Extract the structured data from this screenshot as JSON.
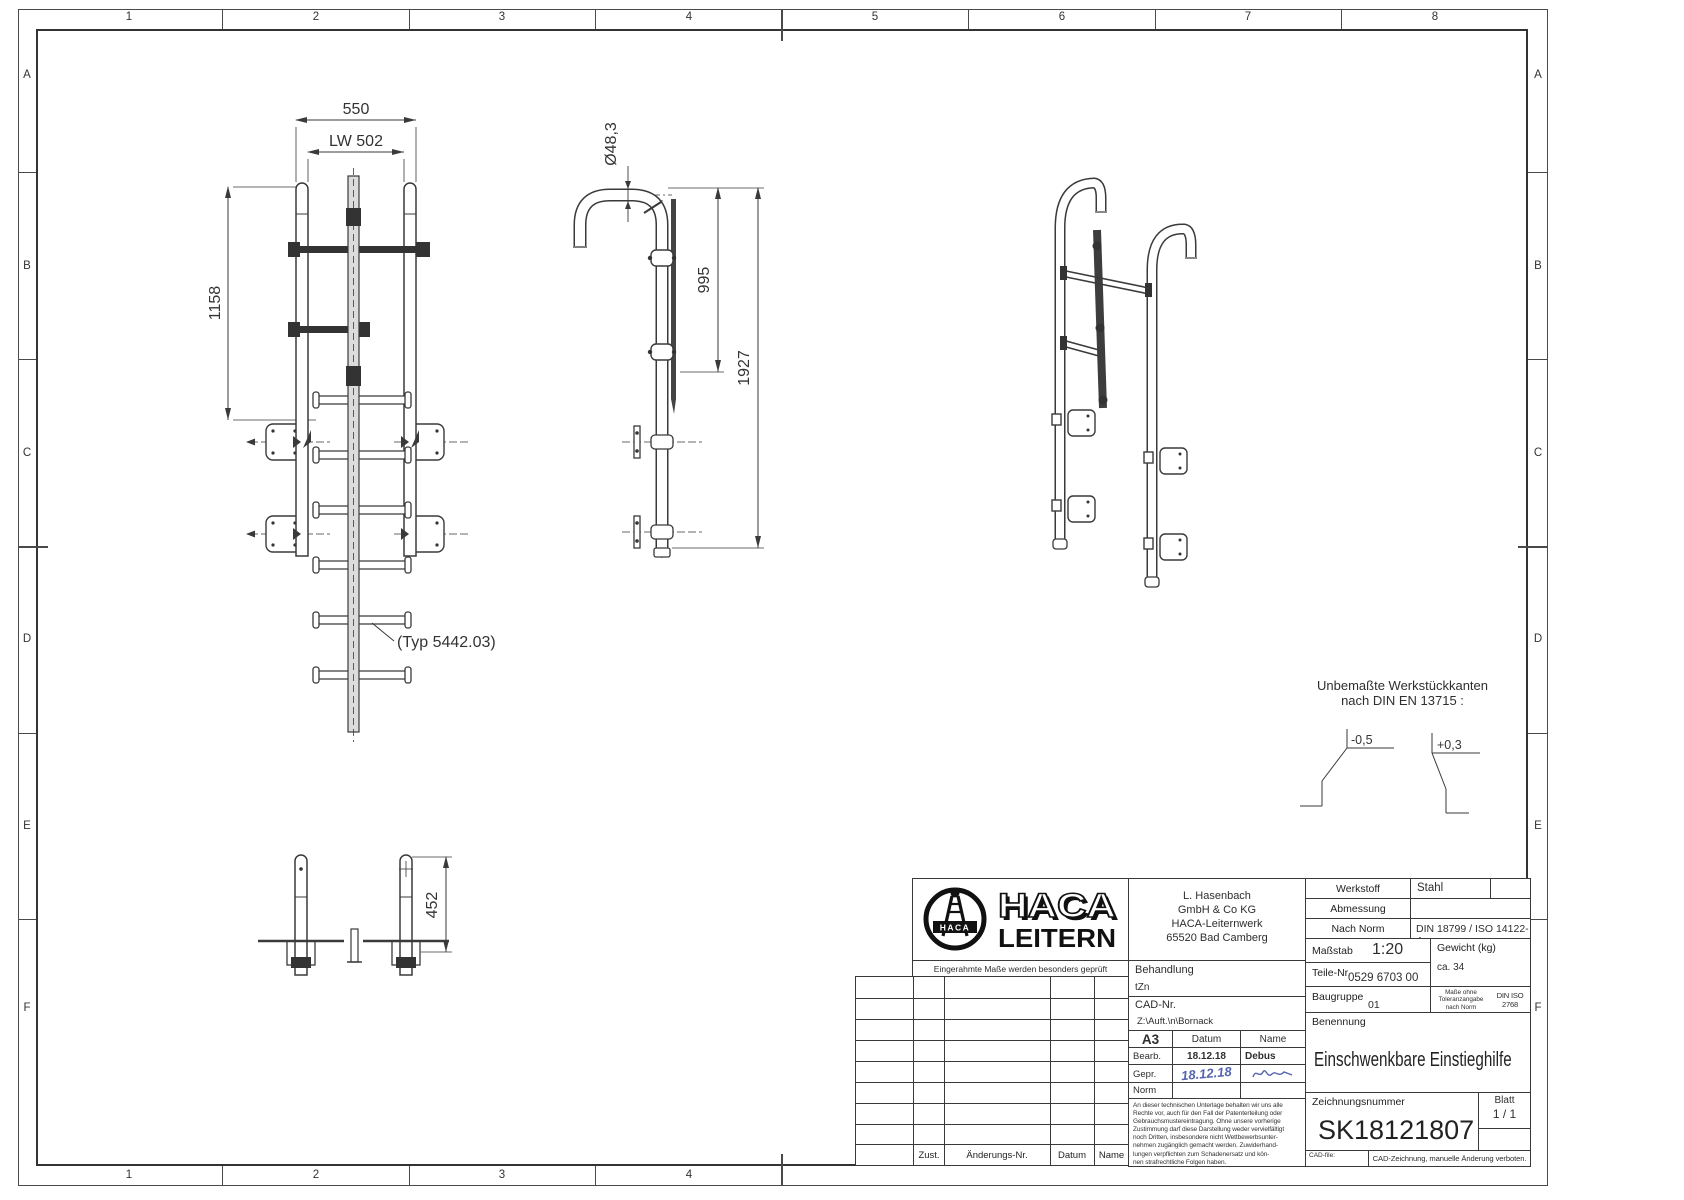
{
  "sheet": {
    "grid": {
      "top": [
        "1",
        "2",
        "3",
        "4",
        "5",
        "6",
        "7",
        "8"
      ],
      "bottom": [
        "1",
        "2",
        "3",
        "4"
      ],
      "left": [
        "A",
        "B",
        "C",
        "D",
        "E",
        "F"
      ],
      "right": [
        "A",
        "B",
        "C",
        "D",
        "E",
        "F"
      ]
    },
    "views": {
      "front": {
        "dim_width": "550",
        "dim_clear_width": "LW 502",
        "dim_upper_length": "1158",
        "type_label": "(Typ 5442.03)"
      },
      "side": {
        "dim_tube_diameter": "Ø48,3",
        "dim_upper": "995",
        "dim_total_length": "1927"
      },
      "bottom_view": {
        "dim_height": "452"
      }
    },
    "edge_note": {
      "line1": "Unbemaßte Werkstückkanten",
      "line2": "nach DIN EN 13715 :",
      "edge_minus": "-0,5",
      "edge_plus": "+0,3"
    },
    "title_block": {
      "logo": {
        "brand_top": "HACA",
        "brand_bottom": "LEITERN",
        "emblem_text": "HACA"
      },
      "address_lines": [
        "L. Hasenbach",
        "GmbH & Co KG",
        "HACA-Leiternwerk",
        "65520 Bad Camberg"
      ],
      "framed_note": "Eingerahmte Maße werden besonders geprüft",
      "werkstoff_label": "Werkstoff",
      "werkstoff_value": "Stahl",
      "abmessung_label": "Abmessung",
      "abmessung_value": "",
      "nach_norm_label": "Nach Norm",
      "nach_norm_value": "DIN 18799 / ISO 14122-4",
      "massstab_label": "Maßstab",
      "massstab_value": "1:20",
      "teile_nr_label": "Teile-Nr.",
      "teile_nr_value": "0529 6703 00",
      "baugruppe_label": "Baugruppe",
      "baugruppe_value": "01",
      "gewicht_label": "Gewicht (kg)",
      "gewicht_value": "ca. 34",
      "toleranz_lines": [
        "Maße ohne",
        "Toleranzangabe",
        "nach Norm"
      ],
      "toleranz_norm": "DIN ISO 2768",
      "toleranz_class": "m",
      "behandlung_label": "Behandlung",
      "behandlung_value": "tZn",
      "cad_nr_label": "CAD-Nr.",
      "cad_nr_value": "Z:\\Auft.\\n\\Bornack",
      "format": "A3",
      "approval": {
        "datum_label": "Datum",
        "name_label": "Name",
        "bearb_label": "Bearb.",
        "bearb_datum": "18.12.18",
        "bearb_name": "Debus",
        "gepr_label": "Gepr.",
        "gepr_datum": "18.12.18",
        "norm_label": "Norm"
      },
      "benennung_label": "Benennung",
      "benennung_value": "Einschwenkbare Einstieghilfe",
      "zeichnungsnummer_label": "Zeichnungsnummer",
      "zeichnungsnummer_value": "SK18121807",
      "blatt_label": "Blatt",
      "blatt_value": "1 / 1",
      "legal_lines": [
        "An dieser technischen Unterlage behalten wir uns alle",
        "Rechte vor, auch für den Fall der Patenterteilung oder",
        "Gebrauchsmustereintragung. Ohne unsere vorherige",
        "Zustimmung darf diese Darstellung weder vervielfältigt",
        "noch Dritten, insbesondere nicht Wettbewerbsunter-",
        "nehmen zugänglich gemacht werden. Zuwiderhand-",
        "lungen verpflichten zum Schadenersatz und kön-",
        "nen strafrechtliche Folgen haben."
      ],
      "revision_header": {
        "zust": "Zust.",
        "aenderungs_nr": "Änderungs-Nr.",
        "datum": "Datum",
        "name": "Name"
      },
      "cad_file_label": "CAD-file:",
      "cad_note": "CAD-Zeichnung, manuelle Änderung verboten."
    },
    "colors": {
      "line": "#3a3a3a",
      "handwriting": "#5565b0",
      "paper": "#ffffff"
    }
  }
}
